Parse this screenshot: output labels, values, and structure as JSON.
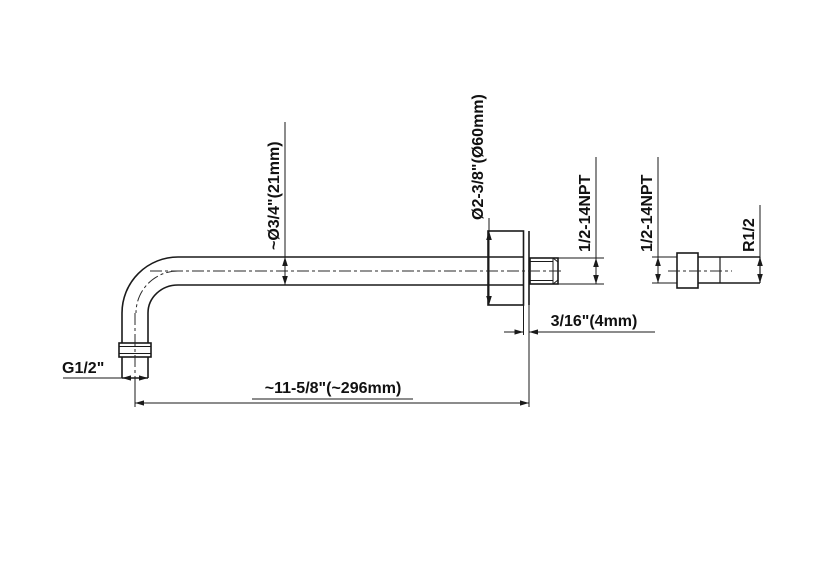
{
  "drawing": {
    "type": "engineering-dimension-drawing",
    "subject": "wall-mount shower arm with flange and separate pipe fitting",
    "labels": {
      "tube_od": "~Ø3/4\"(21mm)",
      "flange_od": "Ø2-3/8\"(Ø60mm)",
      "thread_main": "1/2-14NPT",
      "thread_fitting": "1/2-14NPT",
      "thread_radius": "R1/2",
      "thread_inlet": "G1/2\"",
      "flange_thickness": "3/16\"(4mm)",
      "overall_length": "~11-5/8\"(~296mm)"
    },
    "colors": {
      "line": "#1a1a1a",
      "background": "#ffffff"
    }
  }
}
